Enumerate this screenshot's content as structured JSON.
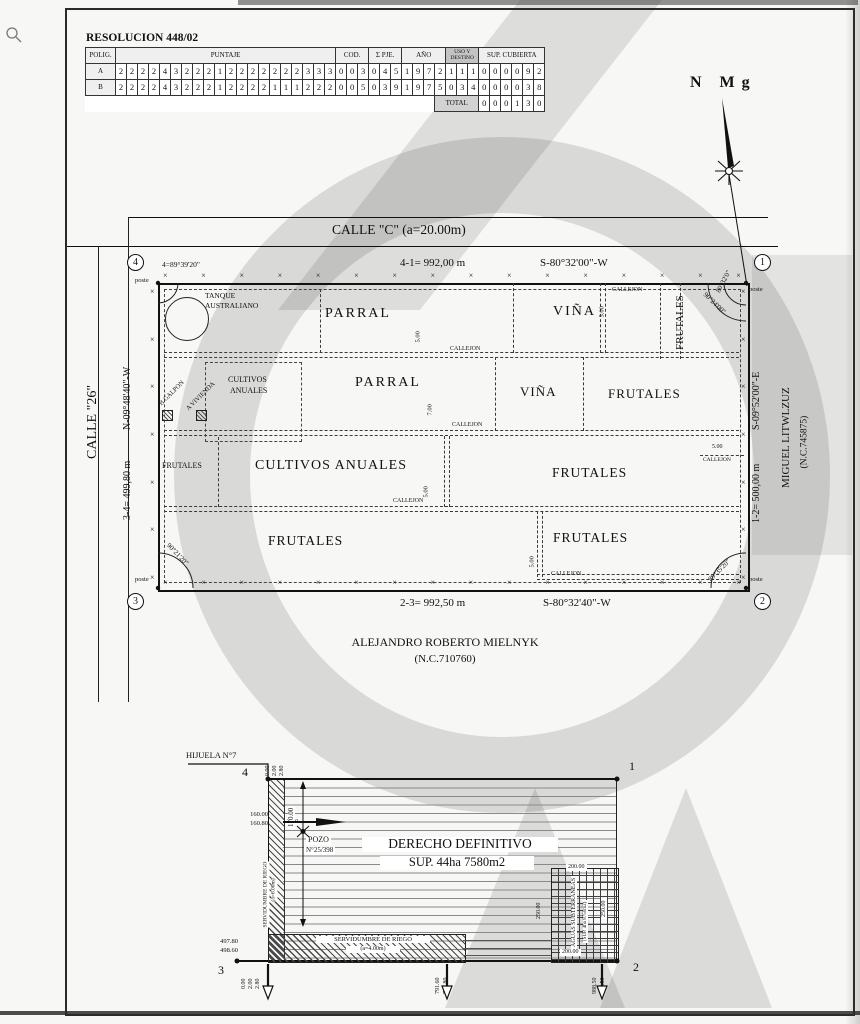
{
  "decor": {
    "fence_tick": "×"
  },
  "cursor": {
    "icon": "magnifier"
  },
  "table": {
    "title": "RESOLUCION 448/02",
    "headers": {
      "polig": "POLIG.",
      "puntaje": "PUNTAJE",
      "cod": "COD.",
      "pje": "Σ PJE.",
      "ano": "AÑO",
      "uso_l1": "USO Y",
      "uso_l2": "DESTINO",
      "sup": "SUP. CUBIERTA"
    },
    "rows": [
      {
        "polig": "A",
        "puntaje": [
          "2",
          "2",
          "2",
          "2",
          "4",
          "3",
          "2",
          "2",
          "2",
          "1",
          "2",
          "2",
          "2",
          "2",
          "2",
          "2",
          "2",
          "3",
          "3",
          "3"
        ],
        "cod": [
          "0",
          "0",
          "3"
        ],
        "pje": [
          "0",
          "4",
          "5"
        ],
        "ano": [
          "1",
          "9",
          "7",
          "2"
        ],
        "uso": [
          "1",
          "1",
          "1"
        ],
        "sup": [
          "0",
          "0",
          "0",
          "0",
          "9",
          "2"
        ]
      },
      {
        "polig": "B",
        "puntaje": [
          "2",
          "2",
          "2",
          "2",
          "4",
          "3",
          "2",
          "2",
          "2",
          "1",
          "2",
          "2",
          "2",
          "2",
          "1",
          "1",
          "1",
          "2",
          "2",
          "2"
        ],
        "cod": [
          "0",
          "0",
          "5"
        ],
        "pje": [
          "0",
          "3",
          "9"
        ],
        "ano": [
          "1",
          "9",
          "7",
          "5"
        ],
        "uso": [
          "0",
          "3",
          "4"
        ],
        "sup": [
          "0",
          "0",
          "0",
          "0",
          "3",
          "8"
        ]
      }
    ],
    "total_label": "TOTAL",
    "total": [
      "0",
      "0",
      "0",
      "1",
      "3",
      "0"
    ]
  },
  "compass": {
    "label": "N Mg"
  },
  "plan": {
    "street_top": "CALLE \"C\" (a=20.00m)",
    "street_left": "CALLE \"26\"",
    "side_top": {
      "dim": "4-1= 992,00 m",
      "bearing": "S-80°32'00\"-W"
    },
    "side_bottom": {
      "dim": "2-3= 992,50 m",
      "bearing": "S-80°32'40\"-W"
    },
    "side_left": {
      "dim": "3-4= 499,80 m",
      "bearing": "N-09°48'40\"-W"
    },
    "side_right": {
      "dim": "1-2= 500,00 m",
      "bearing": "S-09°52'00\"-E"
    },
    "corners": {
      "n1": "1",
      "n2": "2",
      "n3": "3",
      "n4": "4",
      "poste": "poste",
      "angle4": "4=89°39'20\"",
      "angle1a": "80°32'0\"",
      "angle1b": "90°24'00\"",
      "angle3": "90°21'20\"",
      "angle2": "89°35'20\""
    },
    "neighbors": {
      "right_name": "MIGUEL LITWLZUZ",
      "right_nc": "(N.C.745875)",
      "bottom_name": "ALEJANDRO ROBERTO MIELNYK",
      "bottom_nc": "(N.C.710760)"
    },
    "zones": {
      "parral": "PARRAL",
      "vina": "VIÑA",
      "frutales": "FRUTALES",
      "cultivos": "CULTIVOS ANUALES",
      "cultivos_l1": "CULTIVOS",
      "cultivos_l2": "ANUALES",
      "callejon": "CALLEJON",
      "tanque_l1": "TANQUE",
      "tanque_l2": "AUSTRALIANO",
      "galpon": "B GALPON",
      "vivienda": "A VIVIENDA"
    },
    "dims": {
      "d5": "5.00",
      "d7": "7.00"
    }
  },
  "lower": {
    "hijuela": "HIJUELA N°7",
    "points": {
      "p1": "1",
      "p2": "2",
      "p3": "3",
      "p4": "4"
    },
    "offsets": {
      "o0": "0.00",
      "o2": "2.00",
      "o28": "2.80"
    },
    "left": {
      "a": "160.00",
      "b": "160.80",
      "c": "7.00",
      "d": "170.00"
    },
    "pozo": {
      "l1": "POZO",
      "l2": "N°25/398"
    },
    "title": {
      "l1": "DERECHO DEFINITIVO",
      "l2": "SUP. 44ha 7580m2"
    },
    "serv_v": {
      "l1": "SERVIDUMBRE DE RIEGO",
      "l2": "(a=6.00m)"
    },
    "serv_h": {
      "l1": "SERVIDUMBRE DE RIEGO",
      "l2": "(a=4.00m)"
    },
    "bottom_left": {
      "a": "497.80",
      "b": "498.60"
    },
    "bottom_mid": {
      "a": "791.60",
      "b": "791.80"
    },
    "bottom_right": {
      "a": "988.50",
      "b": "989.50"
    },
    "aguas": {
      "l1": "AGUAS SUBTERRANEAS",
      "l2": "(SUP. 4ha 8750m2)",
      "w": "200.00",
      "h": "250.00"
    }
  }
}
